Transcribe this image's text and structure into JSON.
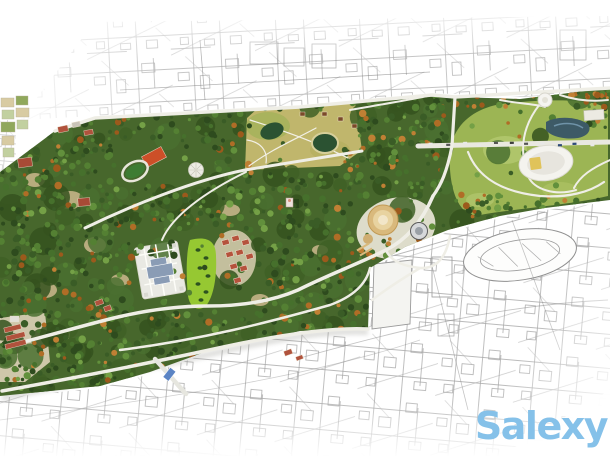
{
  "watermark": {
    "text": "Salexy",
    "color": "#85c1e9"
  },
  "scene": {
    "type": "aerial-park-masterplan-photo",
    "palette": {
      "background": "#ffffff",
      "forest_base": "#47672c",
      "tree_greens": [
        "#2e4b1e",
        "#3a5c26",
        "#46702c",
        "#548033",
        "#62903c",
        "#74a046"
      ],
      "autumn_trees": [
        "#9c5a1c",
        "#b06d26",
        "#c08034"
      ],
      "meadow_field": "#c0b66c",
      "mound_green": "#9cb554",
      "lawn_green": "#96c832",
      "road_light": "#efeee6",
      "pond_blue": "#3d5a66",
      "pond_dark_green": "#2b5232",
      "city_map_line": "#8f8f8f",
      "roof_red": "#b5523c",
      "stadium_red": "#cc4f28",
      "athletic_field_green": "#3e7c33",
      "plaza_building_blue": "#8a9cb5",
      "ground_tan": "#cdb98e",
      "arena_core_yellow": "#e0c35a",
      "bus_blue": "#5b84c4",
      "car_colors": [
        "#3c3c3c",
        "#8a2f22",
        "#e8e8e8",
        "#555555",
        "#2e4a78"
      ]
    }
  }
}
